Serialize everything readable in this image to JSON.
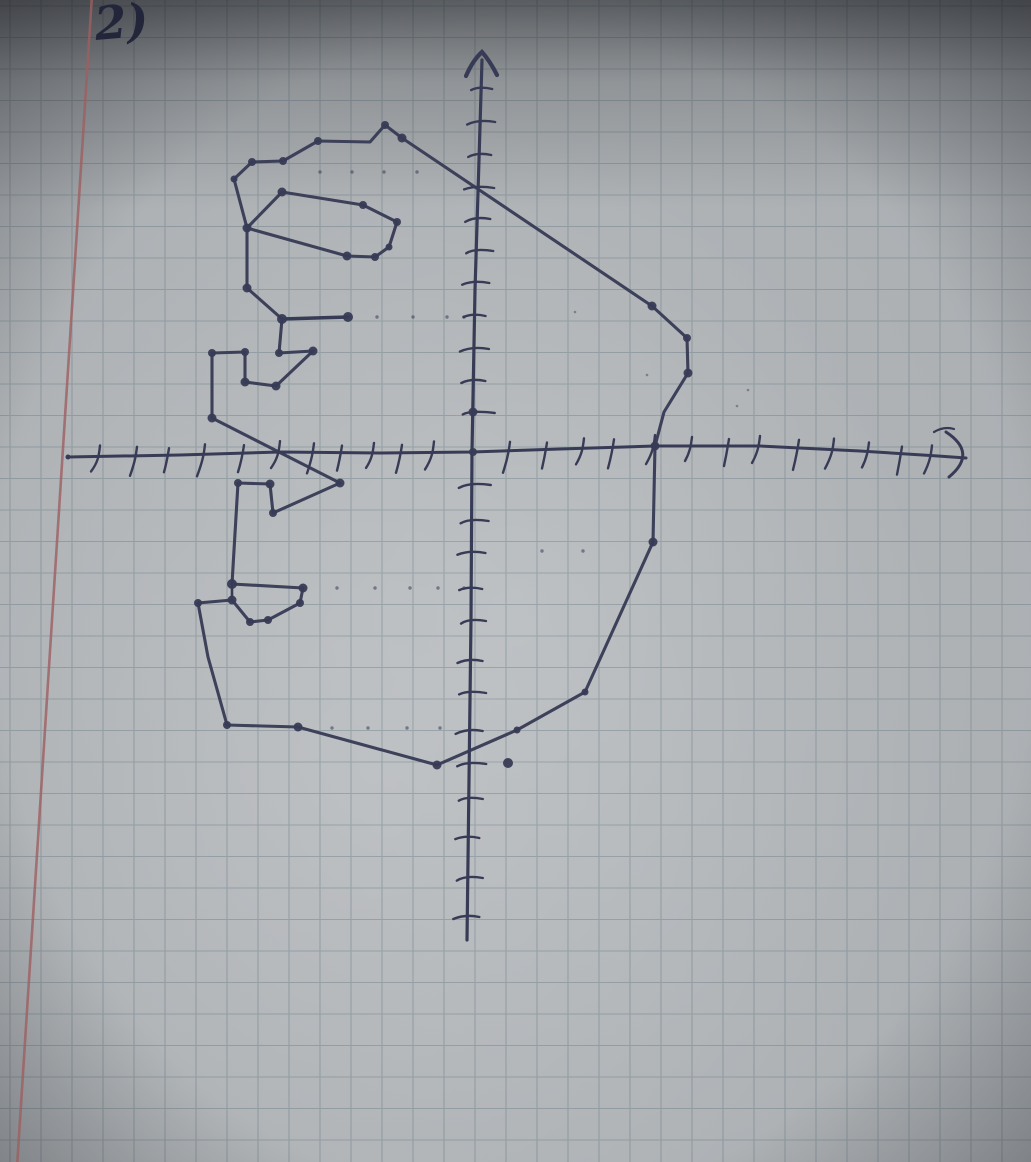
{
  "photo": {
    "label": "2)",
    "colors": {
      "paper_base": "#b5b9bc",
      "grid_line": "rgba(104,126,136,0.42)",
      "margin_line": "#9c5f62",
      "ink": "#383b55",
      "ink_soft": "rgba(56,59,85,0.55)",
      "label_ink": "#23263a"
    },
    "grid": {
      "cell_w": 31,
      "cell_h": 31.5,
      "offset_x": 10,
      "offset_y": 6
    },
    "margin": {
      "x_top": 92,
      "x_bottom": 17
    },
    "coordinate_system": {
      "origin_px": [
        472,
        452
      ],
      "cell_px": 32
    },
    "axes": {
      "x": {
        "points": [
          [
            68,
            457
          ],
          [
            180,
            455
          ],
          [
            280,
            452
          ],
          [
            380,
            453
          ],
          [
            472,
            452
          ],
          [
            560,
            449
          ],
          [
            655,
            446
          ],
          [
            760,
            446
          ],
          [
            860,
            451
          ],
          [
            938,
            456
          ],
          [
            966,
            458
          ]
        ],
        "ticks": [
          98,
          135,
          167,
          203,
          242,
          278,
          312,
          340,
          372,
          400,
          432,
          508,
          545,
          582,
          612,
          653,
          690,
          727,
          758,
          797,
          832,
          867,
          900,
          930
        ],
        "end_hook": {
          "main": "M946,432 Q978,453 949,477",
          "dash": "M934,432 q 10,-6 20,-3"
        },
        "start_dot": [
          68,
          457,
          2.5
        ]
      },
      "y": {
        "points": [
          [
            482,
            60
          ],
          [
            479,
            160
          ],
          [
            475,
            290
          ],
          [
            472,
            452
          ],
          [
            471,
            620
          ],
          [
            469,
            780
          ],
          [
            467,
            940
          ]
        ],
        "ticks": [
          88,
          121,
          154,
          187,
          218,
          250,
          282,
          315,
          348,
          380,
          412,
          484,
          520,
          552,
          588,
          620,
          660,
          692,
          730,
          763,
          798,
          837,
          877,
          916
        ],
        "arrow": "M466,76 Q473,60 482,52 Q490,61 497,75"
      }
    },
    "figure": {
      "outline": [
        [
          234,
          179
        ],
        [
          252,
          162
        ],
        [
          283,
          161
        ],
        [
          318,
          141
        ],
        [
          370,
          142
        ],
        [
          385,
          125
        ],
        [
          402,
          138
        ],
        [
          652,
          306
        ],
        [
          687,
          338
        ],
        [
          688,
          373
        ],
        [
          664,
          412
        ],
        [
          655,
          446
        ],
        [
          653,
          542
        ],
        [
          585,
          692
        ],
        [
          517,
          730
        ],
        [
          437,
          765
        ],
        [
          298,
          727
        ],
        [
          227,
          725
        ],
        [
          208,
          657
        ],
        [
          198,
          603
        ],
        [
          232,
          600
        ],
        [
          250,
          622
        ],
        [
          268,
          620
        ],
        [
          300,
          603
        ],
        [
          303,
          588
        ],
        [
          232,
          584
        ],
        [
          238,
          483
        ],
        [
          270,
          484
        ],
        [
          273,
          513
        ],
        [
          340,
          483
        ],
        [
          212,
          418
        ],
        [
          212,
          353
        ],
        [
          245,
          352
        ],
        [
          245,
          382
        ],
        [
          276,
          386
        ],
        [
          313,
          351
        ],
        [
          279,
          353
        ],
        [
          282,
          319
        ],
        [
          247,
          288
        ],
        [
          247,
          228
        ]
      ],
      "outline_closed": true,
      "curl": [
        [
          282,
          192
        ],
        [
          363,
          205
        ],
        [
          397,
          222
        ],
        [
          389,
          247
        ],
        [
          375,
          257
        ],
        [
          347,
          256
        ],
        [
          247,
          228
        ]
      ],
      "curl_closed": true,
      "arm": [
        [
          282,
          319
        ],
        [
          348,
          317
        ]
      ],
      "seam": [
        [
          232,
          584
        ],
        [
          232,
          601
        ]
      ],
      "grid_points_approx": [
        [
          -7.5,
          8.5
        ],
        [
          -7,
          9
        ],
        [
          -6,
          9
        ],
        [
          -5,
          9.5
        ],
        [
          -3,
          9.5
        ],
        [
          -2.5,
          10
        ],
        [
          -2,
          10
        ],
        [
          5.5,
          4.5
        ],
        [
          6.5,
          3.5
        ],
        [
          7,
          2.5
        ],
        [
          6,
          0
        ],
        [
          6,
          -3
        ],
        [
          3.5,
          -7.5
        ],
        [
          1.5,
          -8.5
        ],
        [
          -1,
          -10
        ],
        [
          -5.5,
          -8.5
        ],
        [
          -7.5,
          -8.5
        ],
        [
          -8.5,
          -4.5
        ],
        [
          -7.5,
          -4.5
        ],
        [
          -7,
          -5.5
        ],
        [
          -6.5,
          -5.5
        ],
        [
          -5.5,
          -4.5
        ],
        [
          -5.5,
          -4
        ],
        [
          -7.5,
          -4
        ],
        [
          -7.5,
          -1
        ],
        [
          -6.5,
          -1
        ],
        [
          -6,
          -2
        ],
        [
          -4,
          -1
        ],
        [
          -8,
          1
        ],
        [
          -8,
          3
        ],
        [
          -7,
          3
        ],
        [
          -7,
          2
        ],
        [
          -6,
          2
        ],
        [
          -5,
          3
        ],
        [
          -6,
          3
        ],
        [
          -6,
          4
        ],
        [
          -7,
          5
        ],
        [
          -7,
          7
        ]
      ]
    },
    "vertex_dots": [
      [
        234,
        179,
        3.5
      ],
      [
        252,
        162,
        4
      ],
      [
        283,
        161,
        4
      ],
      [
        318,
        141,
        4
      ],
      [
        385,
        125,
        4
      ],
      [
        402,
        138,
        4.5
      ],
      [
        652,
        306,
        4.5
      ],
      [
        687,
        338,
        4
      ],
      [
        688,
        373,
        4.5
      ],
      [
        655,
        446,
        4.5
      ],
      [
        653,
        542,
        4.5
      ],
      [
        585,
        692,
        3.5
      ],
      [
        517,
        730,
        3.5
      ],
      [
        437,
        765,
        4.5
      ],
      [
        298,
        727,
        4.5
      ],
      [
        227,
        725,
        4
      ],
      [
        198,
        603,
        4
      ],
      [
        232,
        600,
        4.5
      ],
      [
        250,
        622,
        4
      ],
      [
        268,
        620,
        4
      ],
      [
        300,
        603,
        4
      ],
      [
        303,
        588,
        4.5
      ],
      [
        232,
        584,
        5
      ],
      [
        238,
        483,
        4
      ],
      [
        270,
        484,
        4.5
      ],
      [
        273,
        513,
        4
      ],
      [
        340,
        483,
        4.5
      ],
      [
        212,
        418,
        4.5
      ],
      [
        212,
        353,
        4
      ],
      [
        245,
        352,
        4
      ],
      [
        245,
        382,
        4.5
      ],
      [
        276,
        386,
        4.5
      ],
      [
        313,
        351,
        4.5
      ],
      [
        279,
        353,
        4
      ],
      [
        282,
        319,
        5
      ],
      [
        247,
        288,
        4.5
      ],
      [
        247,
        228,
        4.5
      ],
      [
        282,
        192,
        4.5
      ],
      [
        363,
        205,
        4
      ],
      [
        397,
        222,
        4
      ],
      [
        389,
        247,
        3.5
      ],
      [
        375,
        257,
        4
      ],
      [
        347,
        256,
        4.5
      ],
      [
        348,
        317,
        5
      ],
      [
        473,
        412,
        4.5
      ],
      [
        473,
        452,
        4
      ],
      [
        508,
        763,
        5
      ]
    ],
    "dotted_guides": [
      {
        "y": 172,
        "xs": [
          320,
          352,
          384,
          417
        ]
      },
      {
        "y": 317,
        "xs": [
          377,
          413,
          447,
          464
        ]
      },
      {
        "y": 588,
        "xs": [
          337,
          375,
          410,
          438,
          464
        ]
      },
      {
        "y": 728,
        "xs": [
          332,
          368,
          407,
          440
        ]
      },
      {
        "y": 551,
        "xs": [
          542,
          583
        ]
      }
    ],
    "specks": [
      [
        748,
        390
      ],
      [
        647,
        375
      ],
      [
        575,
        312
      ],
      [
        737,
        406
      ]
    ]
  }
}
